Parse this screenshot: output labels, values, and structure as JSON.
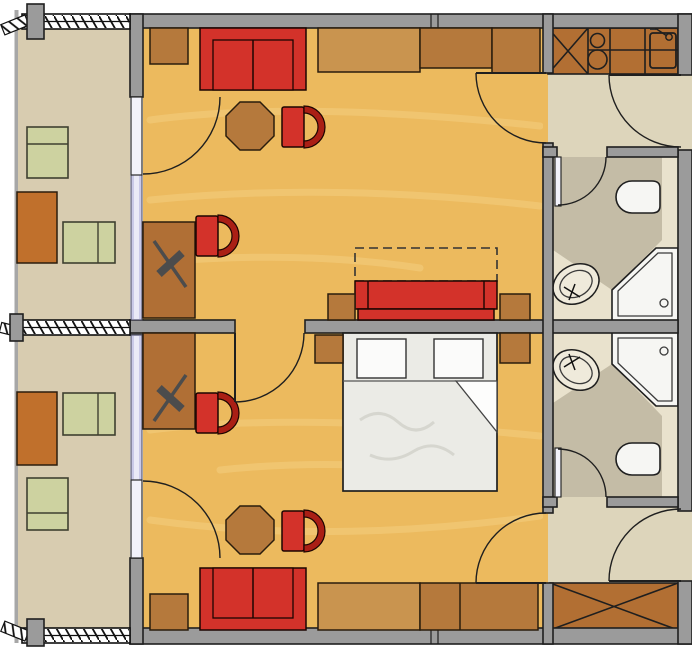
{
  "meta": {
    "kind": "architectural-floor-plan",
    "description": "mirrored pair of hotel rooms with balconies, entry halls and bathrooms",
    "width_px": 692,
    "height_px": 648
  },
  "palette": {
    "wall": "#9b9b9b",
    "line": "#1f1f1f",
    "wood_floor": "#ecba5e",
    "wood_grain": "#f6d287",
    "balcony_floor": "#d8ccb0",
    "tile_floor": "#ddd5bb",
    "bath_light": "#e9e2cd",
    "bath_dark": "#c4bca6",
    "window_glass": "#c9c9e8",
    "red": "#d3322a",
    "red_dark": "#aa1f15",
    "wood_mid": "#b5793c",
    "wood_light": "#c9944f",
    "wood_desk": "#b06f35",
    "wood_counter": "#b26f33",
    "wood_orange": "#c0702c",
    "green": "#cdd2a0",
    "fixture": "#f6f6f3",
    "bed": "#ebebe6",
    "lamp": "#4c4c4c"
  },
  "plan": {
    "balconies": [
      {
        "name": "balcony-upper",
        "floor": "concrete-beige",
        "railing": "hatched-band-with-posts",
        "furniture": [
          "lounge-chair",
          "wood-table",
          "double-lounger"
        ]
      },
      {
        "name": "balcony-lower",
        "floor": "concrete-beige",
        "railing": "hatched-band-with-posts",
        "furniture": [
          "double-lounger",
          "wood-table",
          "lounge-chair"
        ]
      }
    ],
    "rooms": [
      {
        "name": "room-upper",
        "floor": "wood",
        "furniture": [
          "side-table",
          "red-sofa",
          "sideboard",
          "wardrobe-two-sections",
          "octagon-table",
          "tub-chair",
          "desk",
          "desk-lamp",
          "desk-chair",
          "red-day-bed",
          "day-bed-pullout-dashed",
          "flank-table-left",
          "flank-table-right"
        ],
        "doors": [
          "balcony-door",
          "entry-door",
          "connecting-door"
        ]
      },
      {
        "name": "room-lower",
        "floor": "wood",
        "furniture": [
          "double-bed",
          "pillow-left",
          "pillow-right",
          "blanket-fold",
          "nightstand-left",
          "nightstand-right",
          "desk",
          "desk-lamp",
          "desk-chair",
          "octagon-table",
          "tub-chair",
          "red-sofa",
          "side-table",
          "sideboard",
          "wardrobe"
        ],
        "doors": [
          "balcony-door",
          "entry-door",
          "connecting-door"
        ]
      }
    ],
    "halls": [
      {
        "name": "hall-upper",
        "floor": "tile",
        "kitchenette": [
          "cabinet-x",
          "cooktop-two-burners",
          "counter",
          "sink-with-faucet"
        ]
      },
      {
        "name": "hall-lower",
        "floor": "tile",
        "features": [
          "wardrobe-x"
        ]
      }
    ],
    "bathrooms": [
      {
        "name": "bathroom-upper",
        "fixtures": [
          "toilet",
          "oval-washbasin-with-tap",
          "corner-shower-with-drain"
        ]
      },
      {
        "name": "bathroom-lower",
        "fixtures": [
          "corner-shower-with-drain",
          "oval-washbasin-with-tap",
          "toilet"
        ]
      }
    ],
    "counts": {
      "door_swing_arcs": 9,
      "windows": 2,
      "cooktop_burners": 2,
      "red_tub_chairs": 4,
      "octagon_tables": 2,
      "showers": 2,
      "toilets": 2,
      "washbasins": 2
    }
  }
}
